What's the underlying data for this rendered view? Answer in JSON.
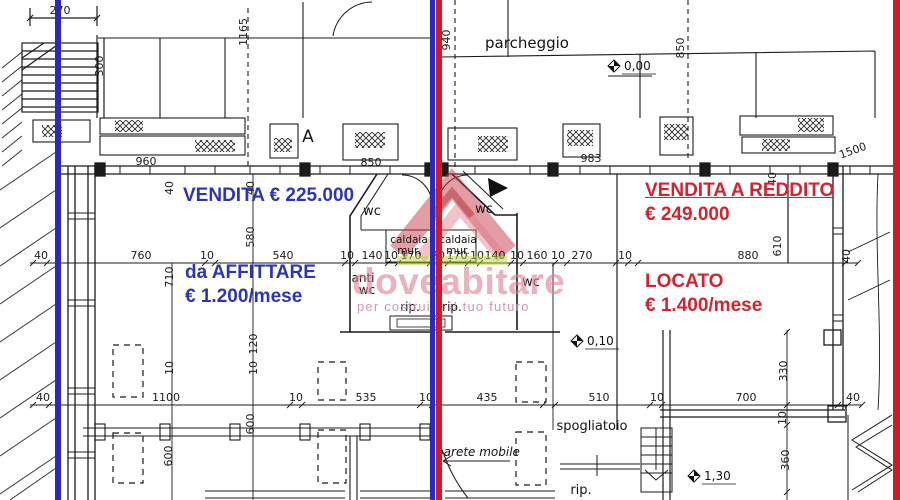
{
  "annotations": {
    "left_sale": "VENDITA € 225.000",
    "left_rent_line1": "da AFFITTARE",
    "left_rent_line2": "€ 1.200/mese",
    "right_sale_line1": "VENDITA A REDDITO",
    "right_sale_line2": "€ 249.000",
    "right_rent_line1": "LOCATO",
    "right_rent_line2": "€ 1.400/mese"
  },
  "watermark": {
    "brand": "doveabitare",
    "tagline": "per costruire il tuo futuro"
  },
  "colors": {
    "accent-blue": "#2b36b4",
    "accent-red": "#d2232e",
    "divider-blue": "#2a2ac0",
    "divider-red": "#d11a24",
    "pink": "#de7f93",
    "green": "#b8d435"
  },
  "plan_labels": [
    {
      "t": "parcheggio",
      "x": 527,
      "y": 48,
      "fs": 15
    },
    {
      "t": "A",
      "x": 308,
      "y": 142,
      "fs": 17
    },
    {
      "t": "wc",
      "x": 372,
      "y": 215,
      "fs": 13
    },
    {
      "t": "wc",
      "x": 484,
      "y": 213,
      "fs": 13
    },
    {
      "t": "caldaia",
      "x": 409,
      "y": 243,
      "fs": 10.5
    },
    {
      "t": "mur.",
      "x": 409,
      "y": 254,
      "fs": 10.5
    },
    {
      "t": "caldaia",
      "x": 458,
      "y": 243,
      "fs": 10.5
    },
    {
      "t": "mur.",
      "x": 458,
      "y": 254,
      "fs": 10.5
    },
    {
      "t": "anti",
      "x": 363,
      "y": 282,
      "fs": 12
    },
    {
      "t": "wc",
      "x": 367,
      "y": 294,
      "fs": 12
    },
    {
      "t": "wc",
      "x": 531,
      "y": 286,
      "fs": 13
    },
    {
      "t": "rip.",
      "x": 410,
      "y": 311,
      "fs": 12
    },
    {
      "t": "rip.",
      "x": 452,
      "y": 311,
      "fs": 12
    },
    {
      "t": "spogliatoio",
      "x": 592,
      "y": 430,
      "fs": 13
    },
    {
      "t": "parete mobile",
      "x": 478,
      "y": 456,
      "fs": 12,
      "i": 1
    },
    {
      "t": "rip.",
      "x": 581,
      "y": 494,
      "fs": 13
    }
  ],
  "levels": [
    {
      "t": "0,00",
      "x": 614,
      "y": 66
    },
    {
      "t": "0,10",
      "x": 577,
      "y": 341
    },
    {
      "t": "1,30",
      "x": 694,
      "y": 476
    }
  ],
  "dimensions": [
    {
      "t": "270",
      "x": 60,
      "y": 14
    },
    {
      "t": "300",
      "x": 103,
      "y": 66,
      "r": -90
    },
    {
      "t": "1165",
      "x": 247,
      "y": 32,
      "r": -90
    },
    {
      "t": "940",
      "x": 450,
      "y": 40,
      "r": -90
    },
    {
      "t": "850",
      "x": 684,
      "y": 48,
      "r": -90
    },
    {
      "t": "960",
      "x": 146,
      "y": 165
    },
    {
      "t": "850",
      "x": 371,
      "y": 166
    },
    {
      "t": "983",
      "x": 591,
      "y": 162
    },
    {
      "t": "1500",
      "x": 854,
      "y": 154,
      "r": -20
    },
    {
      "t": "40",
      "x": 41,
      "y": 259
    },
    {
      "t": "760",
      "x": 141,
      "y": 259
    },
    {
      "t": "10",
      "x": 207,
      "y": 259
    },
    {
      "t": "540",
      "x": 283,
      "y": 259
    },
    {
      "t": "10",
      "x": 347,
      "y": 259
    },
    {
      "t": "140",
      "x": 372,
      "y": 259
    },
    {
      "t": "10",
      "x": 391,
      "y": 259
    },
    {
      "t": "170",
      "x": 411,
      "y": 259
    },
    {
      "t": "20",
      "x": 438,
      "y": 259
    },
    {
      "t": "170",
      "x": 457,
      "y": 259
    },
    {
      "t": "10",
      "x": 477,
      "y": 259
    },
    {
      "t": "140",
      "x": 495,
      "y": 259
    },
    {
      "t": "10",
      "x": 517,
      "y": 259
    },
    {
      "t": "160",
      "x": 537,
      "y": 259
    },
    {
      "t": "10",
      "x": 558,
      "y": 259
    },
    {
      "t": "270",
      "x": 582,
      "y": 259
    },
    {
      "t": "10",
      "x": 625,
      "y": 259
    },
    {
      "t": "880",
      "x": 748,
      "y": 259
    },
    {
      "t": "40",
      "x": 850,
      "y": 256,
      "r": -90
    },
    {
      "t": "40",
      "x": 173,
      "y": 188,
      "r": -90
    },
    {
      "t": "40",
      "x": 254,
      "y": 188,
      "r": -90
    },
    {
      "t": "40",
      "x": 776,
      "y": 179,
      "r": -90
    },
    {
      "t": "580",
      "x": 254,
      "y": 237,
      "r": -90
    },
    {
      "t": "710",
      "x": 173,
      "y": 277,
      "r": -90
    },
    {
      "t": "610",
      "x": 781,
      "y": 246,
      "r": -90
    },
    {
      "t": "120",
      "x": 257,
      "y": 344,
      "r": -90
    },
    {
      "t": "10",
      "x": 173,
      "y": 368,
      "r": -90
    },
    {
      "t": "10",
      "x": 257,
      "y": 368,
      "r": -90
    },
    {
      "t": "600",
      "x": 254,
      "y": 424,
      "r": -90
    },
    {
      "t": "600",
      "x": 172,
      "y": 456,
      "r": -90
    },
    {
      "t": "330",
      "x": 787,
      "y": 371,
      "r": -90
    },
    {
      "t": "10",
      "x": 786,
      "y": 418,
      "r": -90
    },
    {
      "t": "360",
      "x": 789,
      "y": 460,
      "r": -90
    },
    {
      "t": "40",
      "x": 43,
      "y": 401
    },
    {
      "t": "1100",
      "x": 166,
      "y": 401
    },
    {
      "t": "10",
      "x": 296,
      "y": 401
    },
    {
      "t": "535",
      "x": 366,
      "y": 401
    },
    {
      "t": "10",
      "x": 426,
      "y": 401
    },
    {
      "t": "435",
      "x": 487,
      "y": 401
    },
    {
      "t": "510",
      "x": 599,
      "y": 401
    },
    {
      "t": "10",
      "x": 657,
      "y": 401
    },
    {
      "t": "700",
      "x": 746,
      "y": 401
    },
    {
      "t": "40",
      "x": 853,
      "y": 401
    }
  ]
}
